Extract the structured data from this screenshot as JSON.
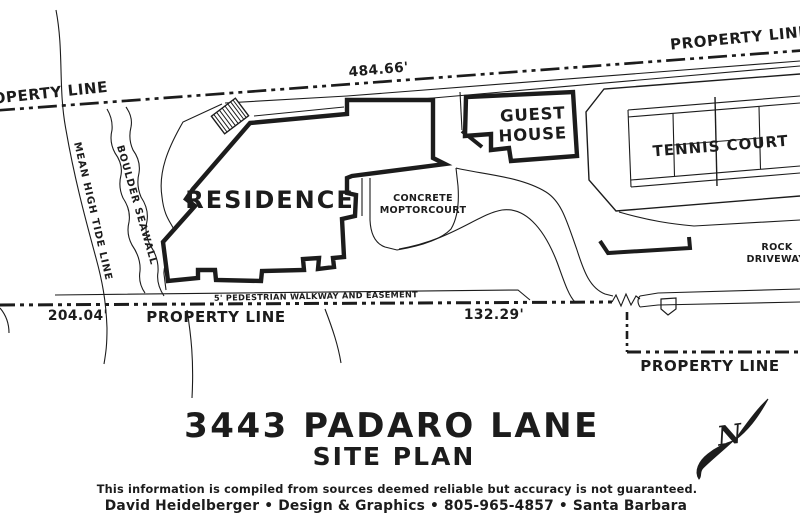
{
  "site_plan": {
    "colors": {
      "ink": "#1c1c1c",
      "paper": "#ffffff"
    },
    "property_lines": {
      "top_left_label": "PROPERTY LINE",
      "top_right_label": "PROPERTY LINE",
      "bottom_label": "PROPERTY LINE",
      "bottom_right_label": "PROPERTY LINE",
      "top_dimension": "484.66'",
      "bottom_left_dimension": "204.04'",
      "bottom_mid_dimension": "132.29'"
    },
    "features": {
      "residence": "RESIDENCE",
      "guest_house_line1": "GUEST",
      "guest_house_line2": "HOUSE",
      "tennis_court": "TENNIS COURT",
      "motorcourt_line1": "CONCRETE",
      "motorcourt_line2": "MOPTORCOURT",
      "rock_driveway_line1": "ROCK",
      "rock_driveway_line2": "DRIVEWAY",
      "walkway_easement": "5' PEDESTRIAN WALKWAY AND EASEMENT",
      "mean_high_tide": "MEAN HIGH TIDE LINE",
      "boulder_seawall": "BOULDER SEAWALL",
      "north_indicator": "N"
    },
    "title": {
      "address": "3443 PADARO LANE",
      "subtitle": "SITE PLAN"
    },
    "footer": {
      "disclaimer": "This information is compiled from sources deemed reliable but accuracy is not guaranteed.",
      "credit": "David Heidelberger • Design & Graphics • 805-965-4857 • Santa Barbara"
    }
  }
}
